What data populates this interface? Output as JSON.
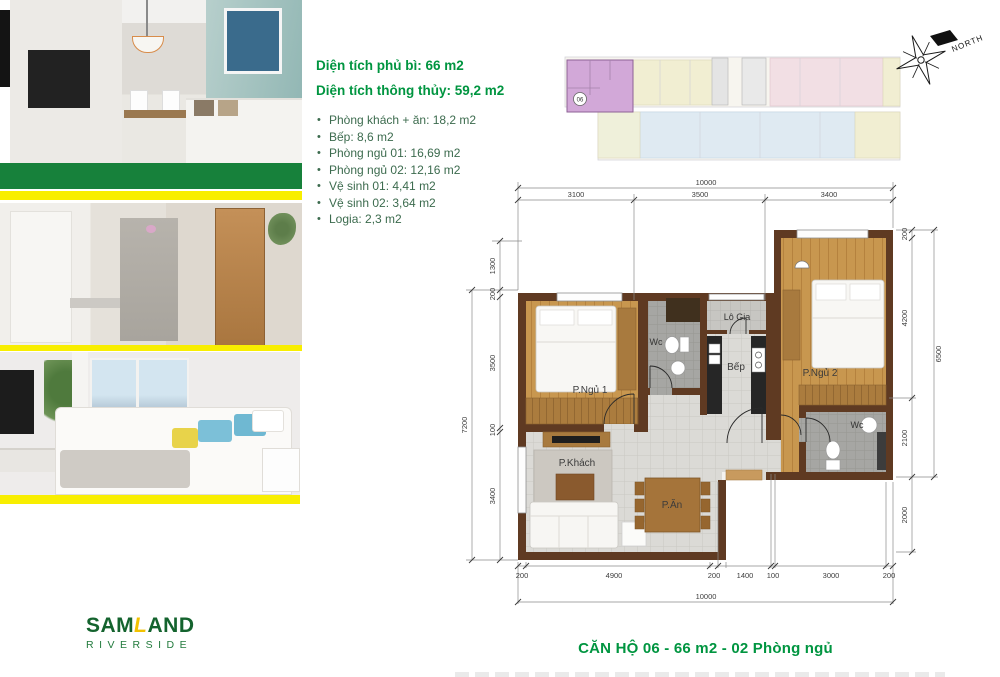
{
  "info": {
    "line1": "Diện tích phủ bì: 66 m2",
    "line2": "Diện tích thông thủy: 59,2 m2",
    "bullets": [
      "Phòng khách + ăn: 18,2 m2",
      "Bếp: 8,6 m2",
      "Phòng ngủ 01: 16,69 m2",
      "Phòng ngủ 02: 12,16 m2",
      "Vệ sinh 01: 4,41 m2",
      "Vệ sinh 02: 3,64 m2",
      "Logia: 2,3 m2"
    ]
  },
  "overview": {
    "unit": "06"
  },
  "compass": {
    "label": "NORTH"
  },
  "plan": {
    "rooms": {
      "bedroom1": "P.Ngủ 1",
      "bedroom2": "P.Ngủ 2",
      "living": "P.Khách",
      "dining": "P.Ăn",
      "kitchen": "Bếp",
      "loggia": "Lô Gia",
      "wc1": "Wc",
      "wc2": "Wc"
    },
    "dims": {
      "top_total": "10000",
      "top": [
        "3100",
        "3500",
        "3400"
      ],
      "bottom": [
        "200",
        "4900",
        "200",
        "1400",
        "100",
        "3000",
        "200"
      ],
      "bottom_total": "10000",
      "left": [
        "1300",
        "200",
        "3500",
        "100",
        "3400"
      ],
      "left_total": "7200",
      "right": [
        "200",
        "4200",
        "2100",
        "2000"
      ],
      "right_total": "6500"
    }
  },
  "caption": "CĂN HỘ 06 - 66 m2 - 02 Phòng ngủ",
  "logo": {
    "part1": "SAM",
    "accent": "L",
    "part2": "AND",
    "subtitle": "RIVERSIDE"
  },
  "colors": {
    "accent_green": "#009540",
    "bar_green": "#17813b",
    "bar_yellow": "#f8ee00",
    "wall_brown": "#5f3a22",
    "logo_green": "#14632e",
    "logo_yellow": "#f2c200",
    "highlight_unit": "#d2a8d8"
  }
}
